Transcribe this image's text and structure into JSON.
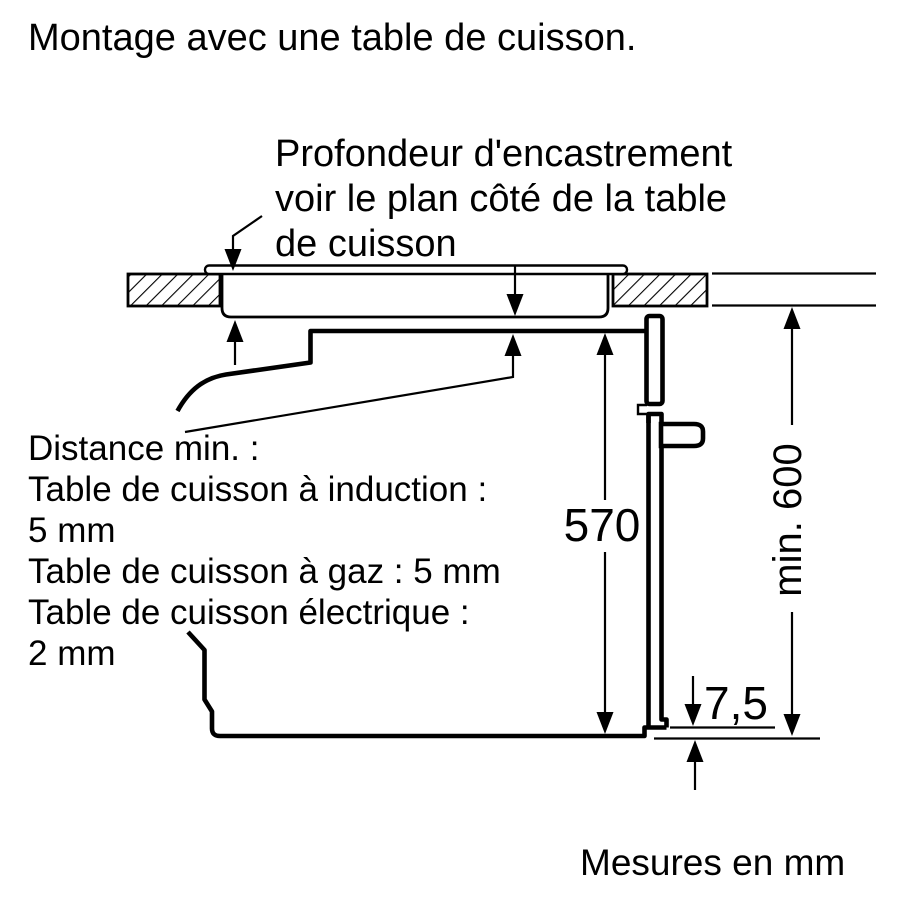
{
  "title": "Montage avec une table de cuisson.",
  "callout": {
    "lines": [
      "Profondeur d'encastrement",
      "voir le plan côté de la table",
      "de cuisson"
    ]
  },
  "distance_note": {
    "lines": [
      "Distance min. :",
      "Table de cuisson à induction :",
      "5 mm",
      "Table de cuisson à gaz : 5 mm",
      "Table de cuisson électrique :",
      "2 mm"
    ]
  },
  "dimensions": {
    "niche_height": "570",
    "door_bottom_offset": "7,5",
    "min_install_height": "min. 600"
  },
  "footer": {
    "units_note": "Mesures en mm"
  },
  "colors": {
    "ink": "#000000",
    "background": "#ffffff"
  }
}
